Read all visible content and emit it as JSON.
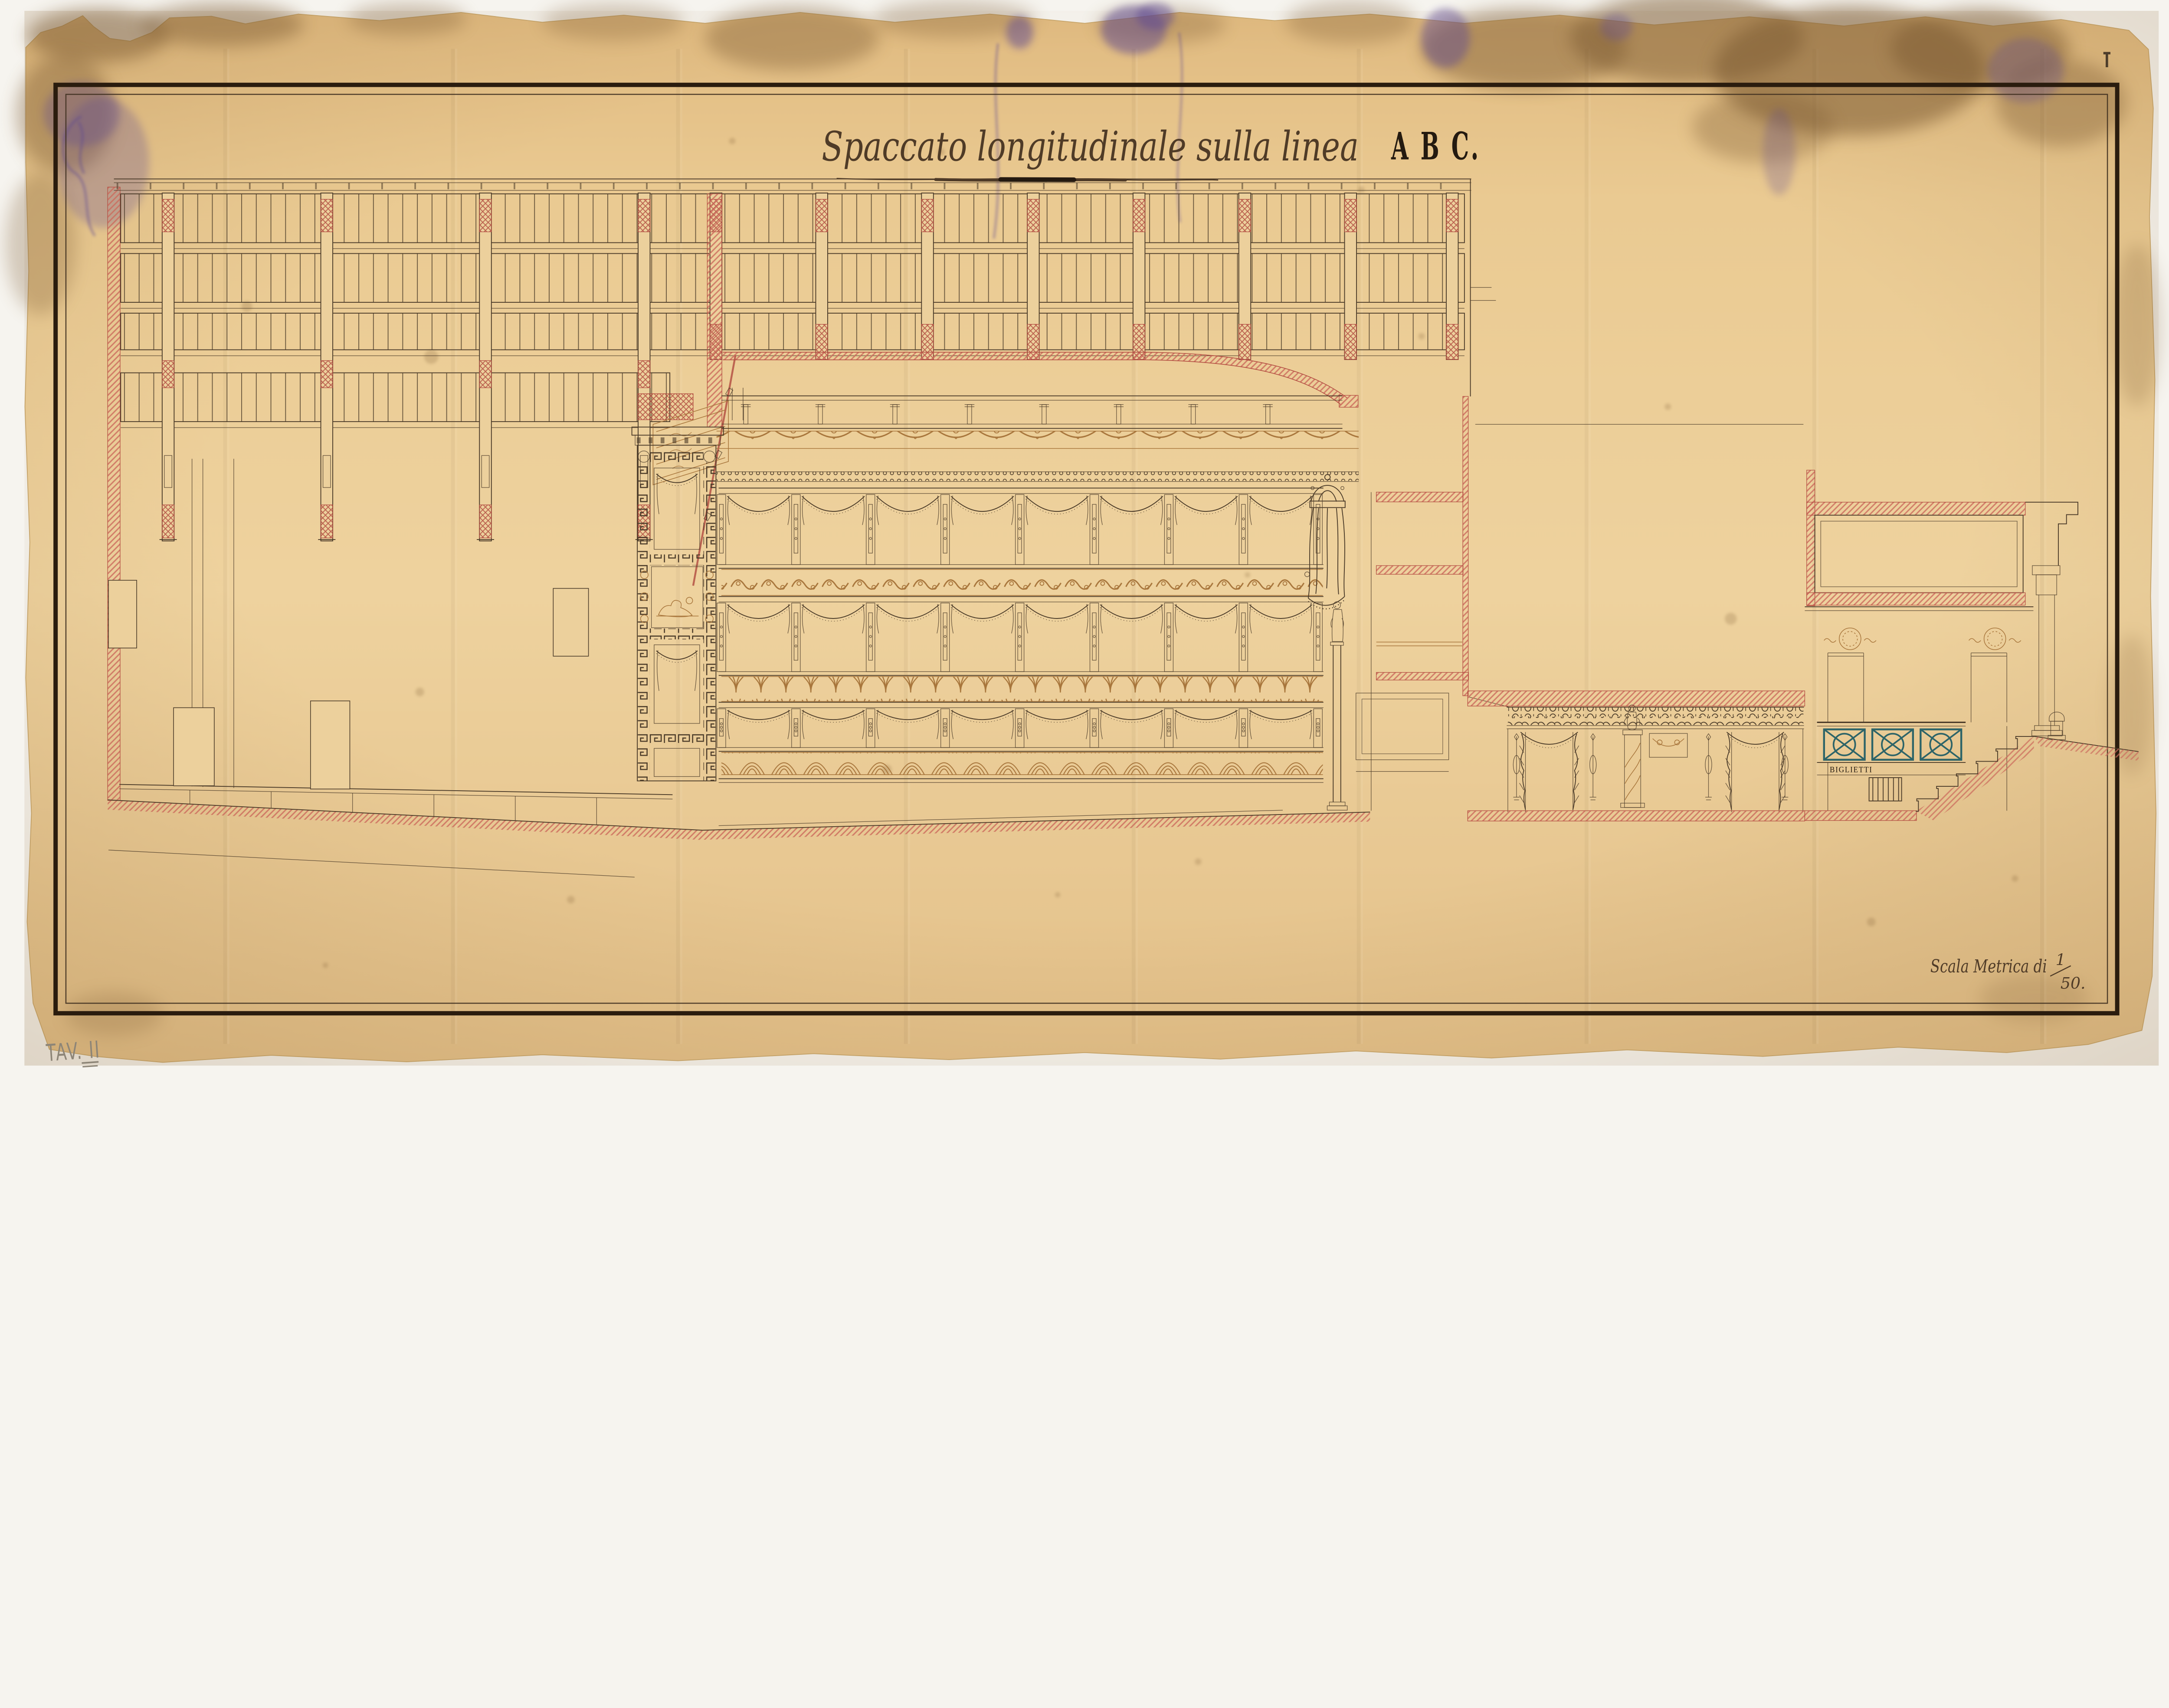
{
  "sheet": {
    "title_script": "Spaccato longitudinale sulla linea",
    "title_letters": "A B C.",
    "scale_label": "Scala Metrica di",
    "scale_fraction_numerator": "1",
    "scale_fraction_denominator": "50.",
    "plate_number": "TAV. II",
    "ticket_sign": "BIGLIETTI"
  },
  "colors": {
    "paper": "#e9c78f",
    "paper2": "#ecd09c",
    "paper_dark": "#dcb578",
    "ink": "#4a3a28",
    "ink_dark": "#241a10",
    "ink_soft": "#4f3b27",
    "sepia": "#a8763c",
    "sepia_dark": "#8a5f2e",
    "red": "#cc6a5c",
    "redd": "#b24b40",
    "teal": "#2d6468",
    "stain_brown": "#7c5a33",
    "stain_purple": "#5f4a92",
    "pencil": "#8d8577",
    "frame": "#2a1c0e"
  }
}
